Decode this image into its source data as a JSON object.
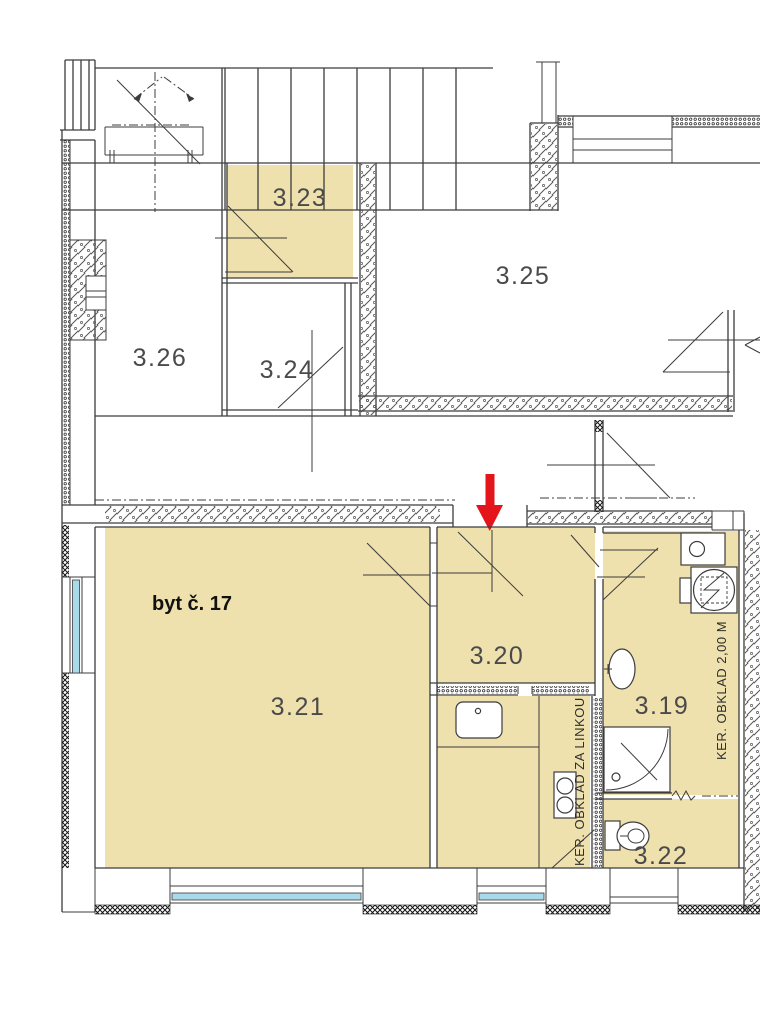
{
  "plan": {
    "apartment_label": "byt č. 17",
    "rooms": {
      "r323": {
        "label": "3.23"
      },
      "r324": {
        "label": "3.24"
      },
      "r325": {
        "label": "3.25"
      },
      "r326": {
        "label": "3.26"
      },
      "r321": {
        "label": "3.21"
      },
      "r320": {
        "label": "3.20"
      },
      "r319": {
        "label": "3.19"
      },
      "r322": {
        "label": "3.22"
      }
    },
    "annotations": {
      "kitchen_tiling": "KER. OBKLAD ZA LINKOU",
      "bathroom_tiling": "KER. OBKLAD 2,00 M"
    },
    "colors": {
      "room_fill": "#EEE1AD",
      "window_glass": "#A9DAEA",
      "arrow": "#E3141B",
      "line_dark": "#3C3C3C"
    }
  }
}
